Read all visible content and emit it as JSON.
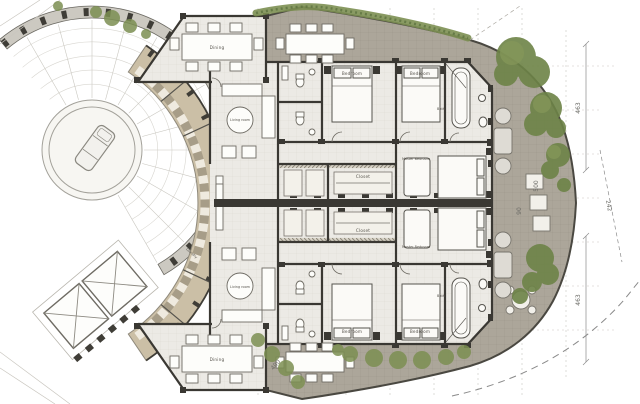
{
  "plan": {
    "type": "architectural-floor-plan",
    "rooms": {
      "dining": [
        "Dining",
        "Dining"
      ],
      "living": [
        "Living room",
        "Living room"
      ],
      "bedrooms": [
        "Bedroom",
        "Bedroom",
        "Bedroom",
        "Bedroom"
      ],
      "masters": [
        "Master Bedroom",
        "Master Bedroom"
      ],
      "closets": [
        "Closet",
        "Closet"
      ],
      "baths": [
        "Bath",
        "Bath"
      ],
      "laundry": "Laundry"
    },
    "dimensions": {
      "right_top": "463",
      "right_bottom": "463",
      "right_edge": "500",
      "edge_small": "90",
      "diagonal": "242",
      "bottom_left": "400"
    },
    "palette": {
      "floor": "#eceae5",
      "corridor_tan": "#cbbfa6",
      "terrace": "#aca69a",
      "greenery": "#6d8347",
      "walls": "#3a3833",
      "ring": "#ccc9c1"
    }
  }
}
